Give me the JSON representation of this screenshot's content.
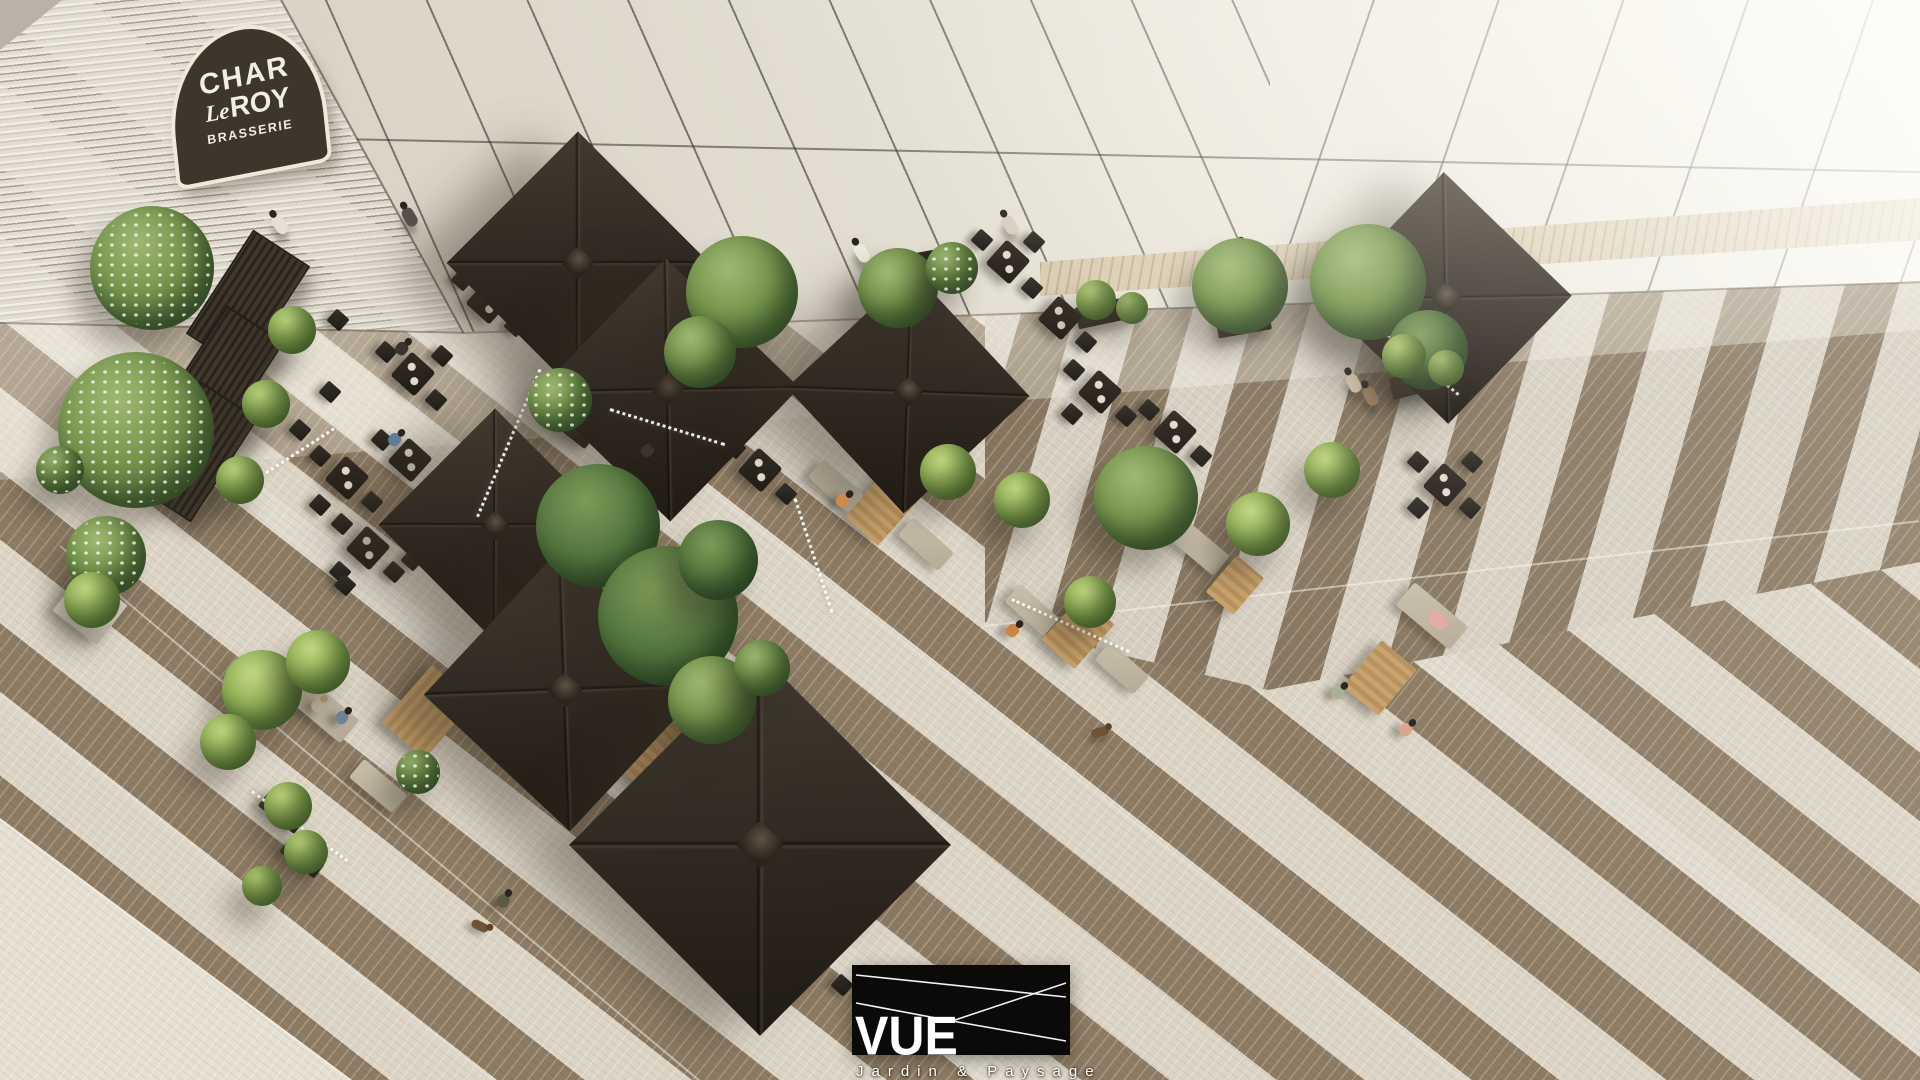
{
  "signage": {
    "brasserie_sign": {
      "line1": "CHAR",
      "line2_prefix": "Le",
      "line2_main": "ROY",
      "line3": "BRASSERIE"
    }
  },
  "logo": {
    "wordmark": "VUE",
    "tagline": "Jardin & Paysage"
  },
  "colors": {
    "sign_bg": "#3e362b",
    "sign_border": "#efe9da",
    "sign_text": "#f3eee1",
    "logo_bg": "#0b0a08",
    "logo_text": "#ffffff",
    "wall_brick": "#d8d1c2",
    "wall_panel_light": "#f2efe8",
    "wall_panel_dark": "#cfc9bb",
    "wall_joint": "#3c3a33",
    "paving_light": "#dcd5c6",
    "paving_brown": "#8d7b63",
    "parasol_canvas": "#332c24",
    "foliage_green": "#6f9049",
    "blossom_white": "#eef2e2",
    "wood_deck": "#c8a06b",
    "bench_grey": "#b5aa96"
  }
}
